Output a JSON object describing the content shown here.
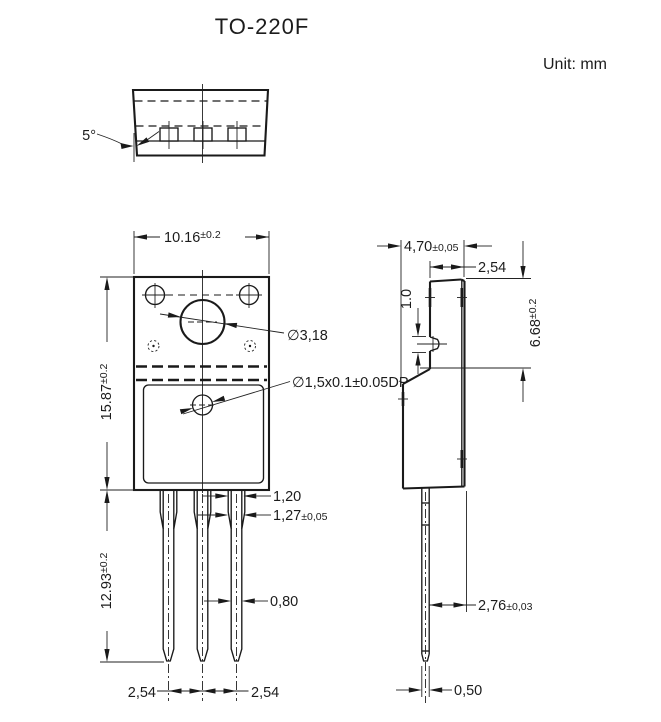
{
  "title": "TO-220F",
  "unit": "Unit: mm",
  "top_view": {
    "draft_angle": "5°"
  },
  "front_view": {
    "width": {
      "value": "10.16",
      "tol": "±0.2"
    },
    "body_height": {
      "value": "15.87",
      "tol": "±0.2"
    },
    "lead_length": {
      "value": "12.93",
      "tol": "±0.2"
    },
    "mounting_hole": "∅3,18",
    "dimple": "∅1,5x0.1±0.05DP",
    "lead_width_top": "1,20",
    "lead_shoulder": {
      "value": "1,27",
      "tol": "±0,05"
    },
    "lead_width": "0,80",
    "pitch_left": "2,54",
    "pitch_right": "2,54"
  },
  "side_view": {
    "depth": {
      "value": "4,70",
      "tol": "±0,05"
    },
    "tab_depth": "2,54",
    "boss": "1.0",
    "upper_height": {
      "value": "6.68",
      "tol": "±0.2"
    },
    "lead_to_back": {
      "value": "2,76",
      "tol": "±0,03"
    },
    "lead_thickness": "0,50"
  }
}
